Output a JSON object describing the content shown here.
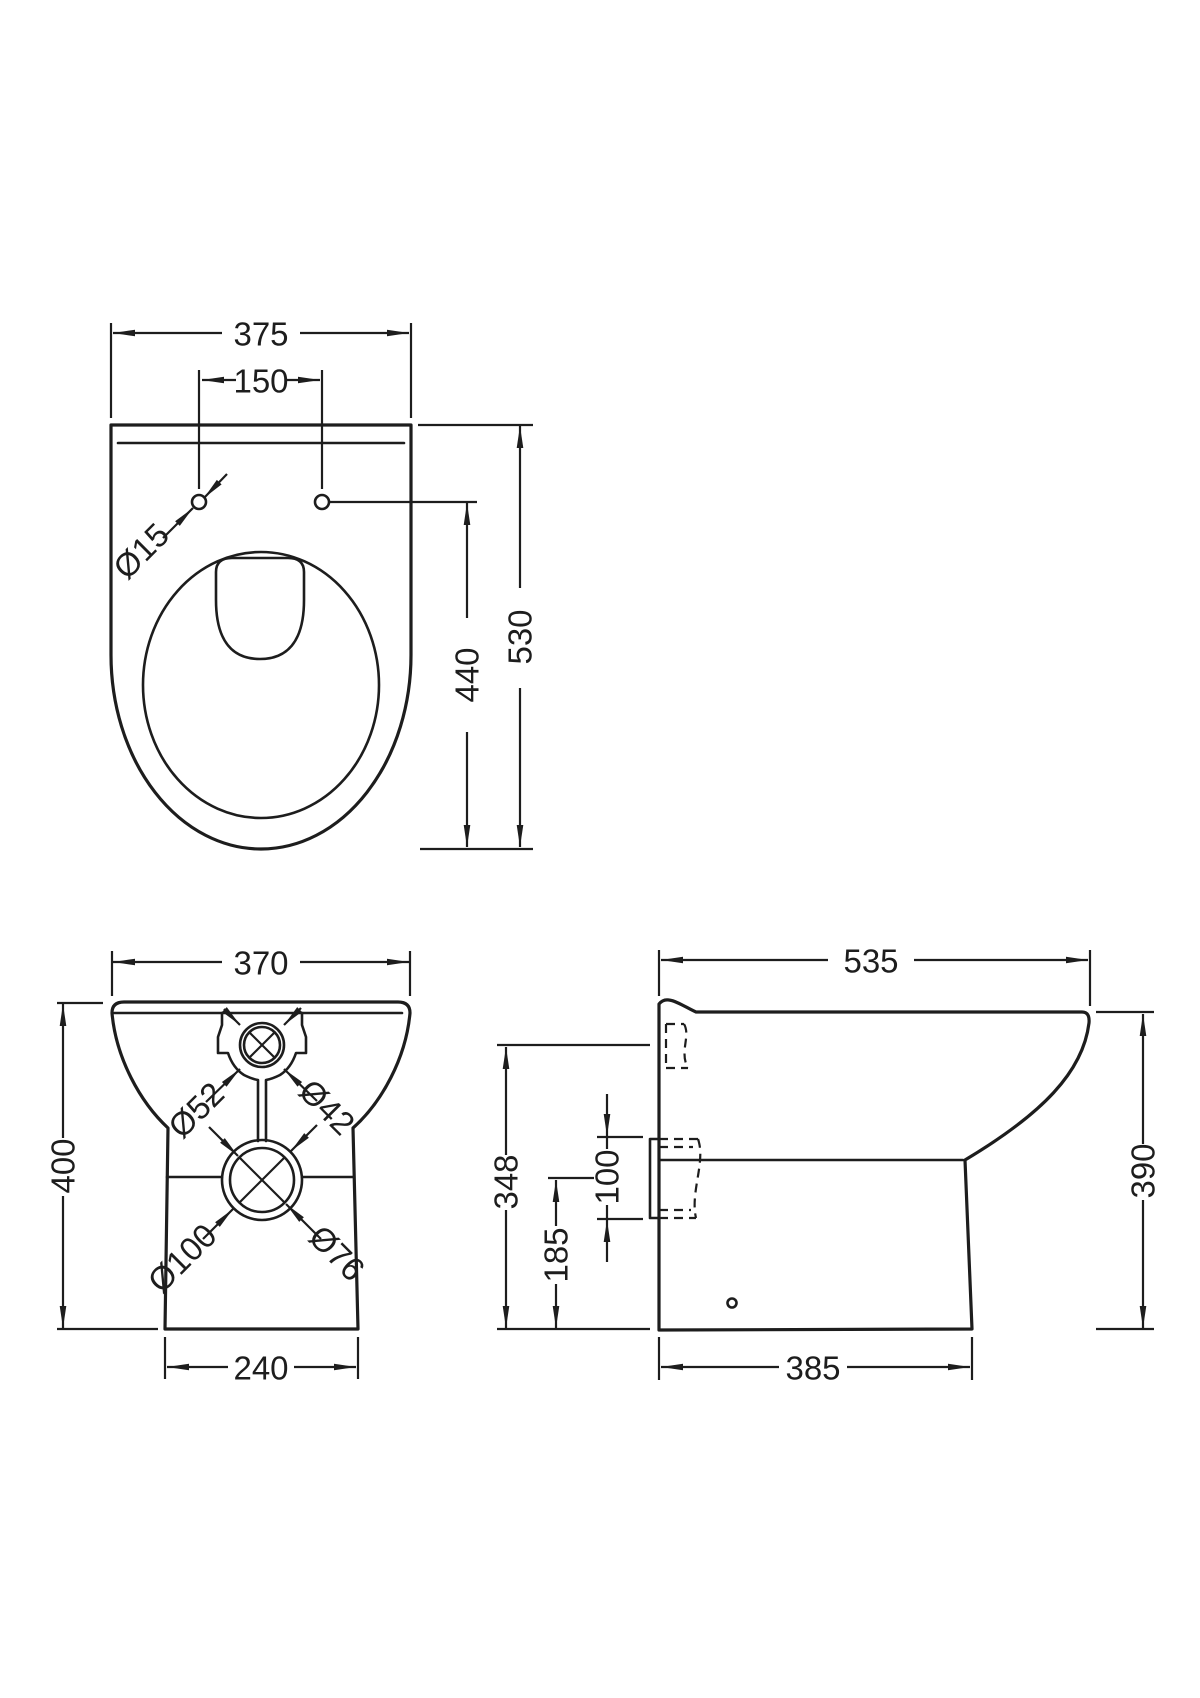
{
  "dims": {
    "plan": {
      "width": "375",
      "hole_spacing": "150",
      "hole_diameter": "Ø15",
      "hole_to_front": "440",
      "depth": "530"
    },
    "front": {
      "width": "370",
      "height": "400",
      "inlet_outer": "Ø52",
      "inlet_inner": "Ø42",
      "outlet_outer": "Ø100",
      "outlet_inner": "Ø76",
      "base_width": "240"
    },
    "side": {
      "depth": "535",
      "inlet_height": "348",
      "outlet_diameter": "100",
      "outlet_center_height": "185",
      "bowl_height": "390",
      "base_depth": "385"
    }
  }
}
